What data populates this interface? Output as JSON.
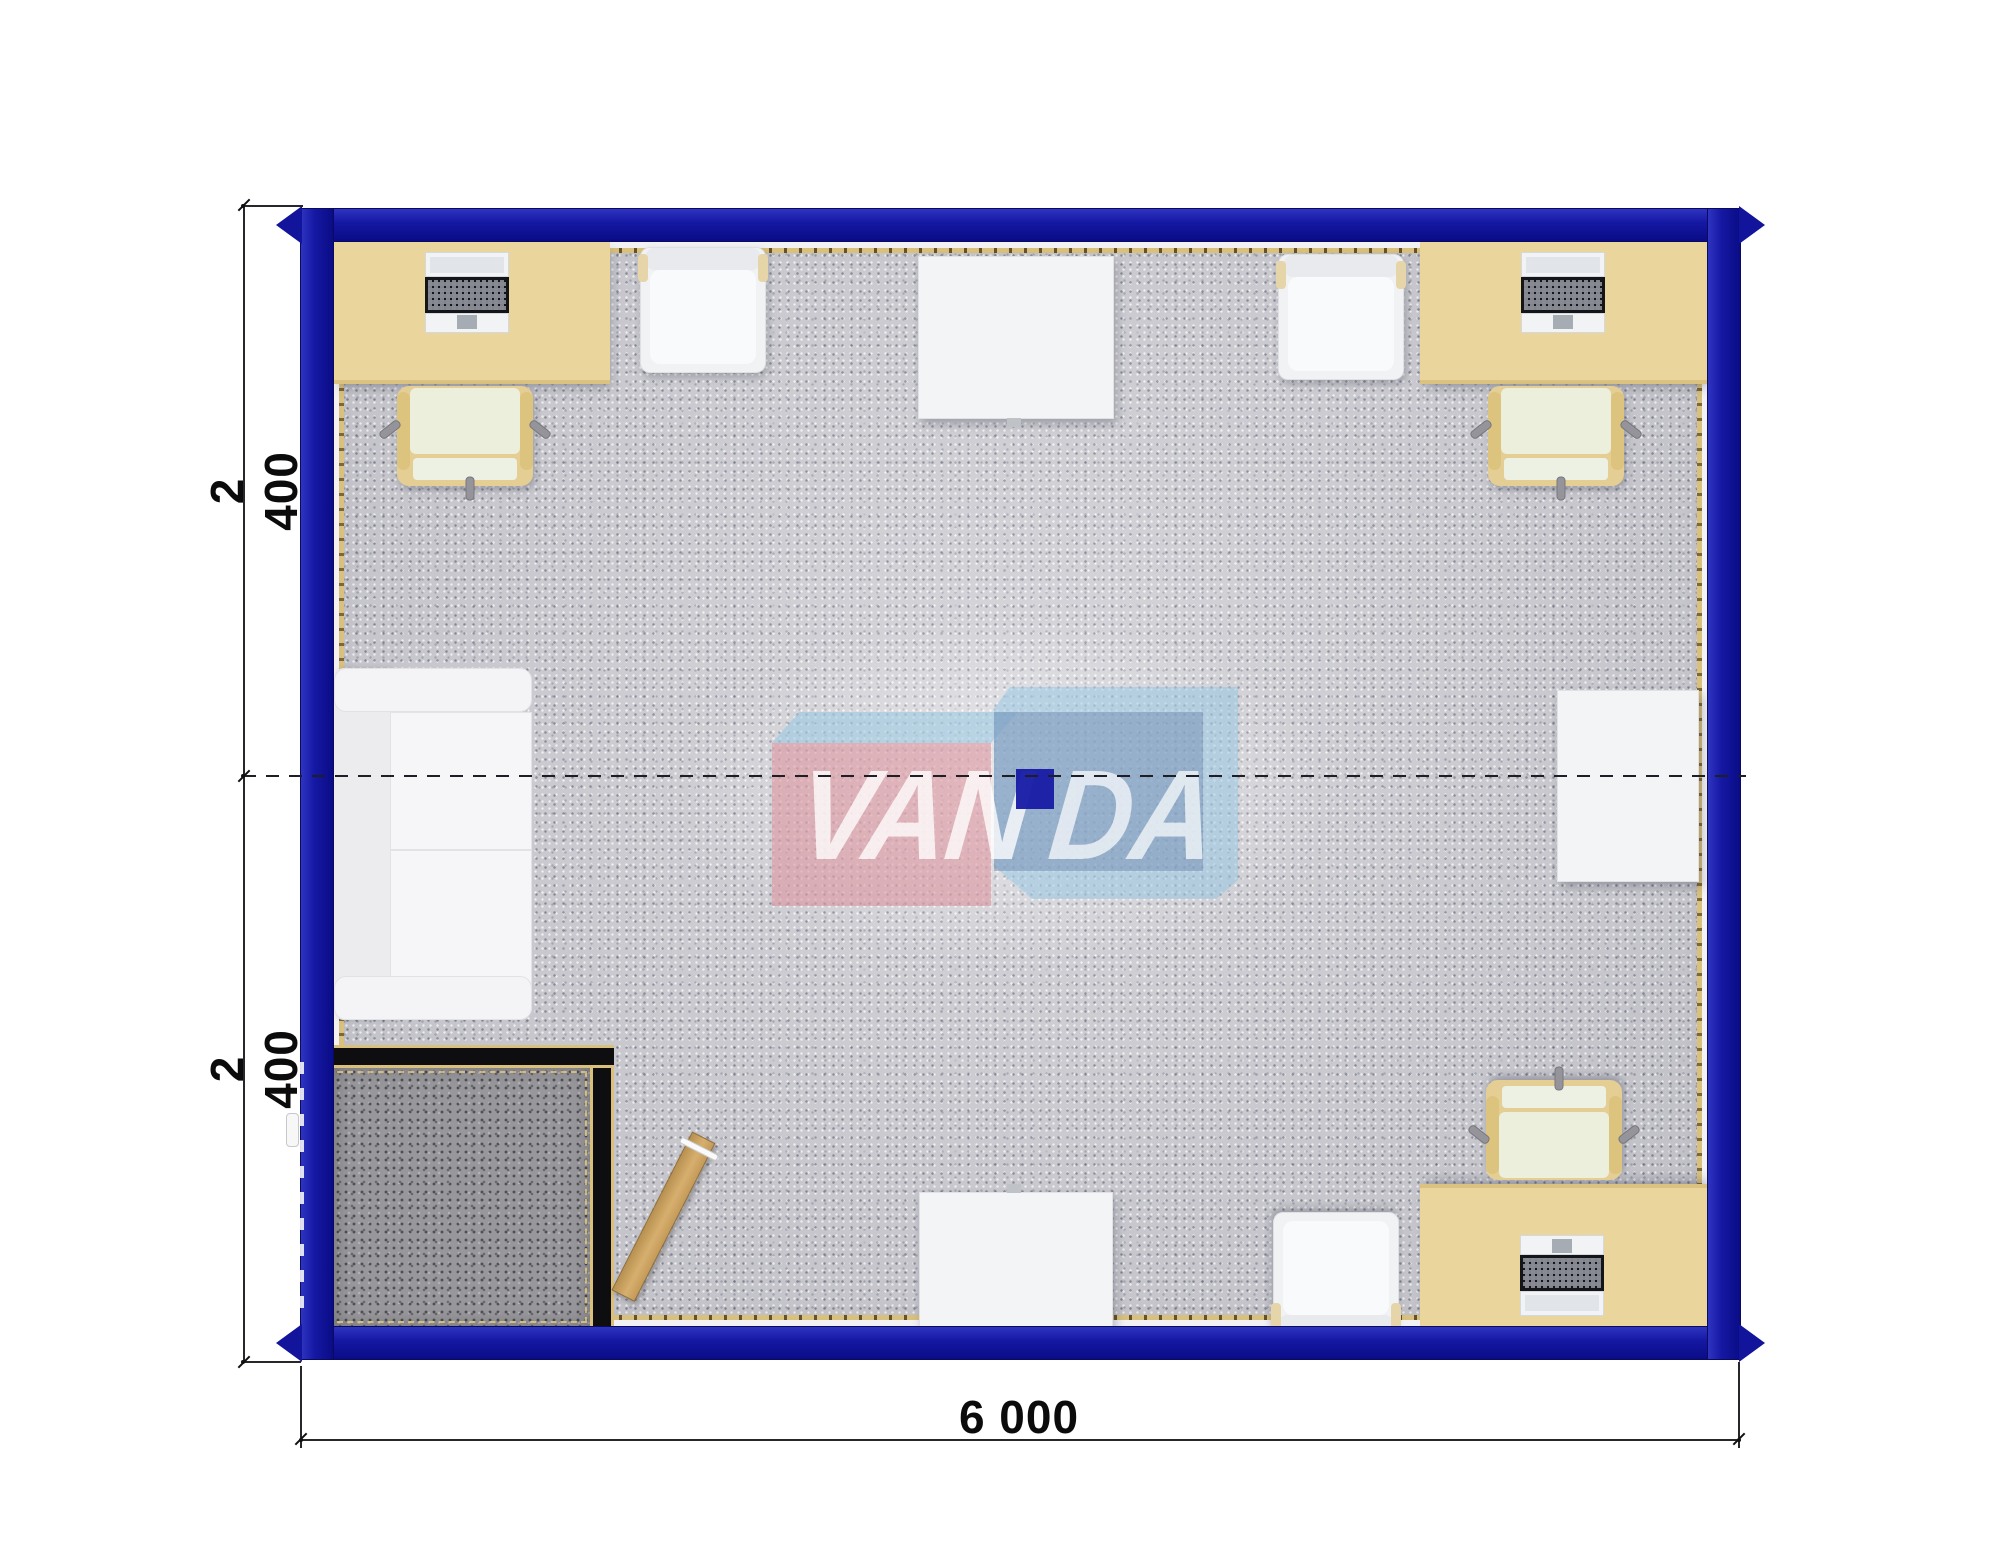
{
  "dimensions": {
    "left_top": "2 400",
    "left_bottom": "2 400",
    "bottom": "6 000"
  },
  "watermark": {
    "brand_left": "VAN",
    "brand_right": "DA"
  },
  "colors": {
    "frame_blue": "#15159E",
    "desk_beige": "#EAD59C",
    "carpet_gray": "#CBCBD1",
    "entry_carpet_gray": "#98989C",
    "furniture_white": "#F3F4F6",
    "chair_seat_cream": "#EBEFDC",
    "logo_pink": "#DFA3AD",
    "logo_light_blue": "#9FC9E2",
    "logo_steel_blue": "#93A9C6",
    "logo_navy": "#181CA6",
    "door_wood": "#C99F62",
    "dimension_text": "#0B0B0B"
  }
}
